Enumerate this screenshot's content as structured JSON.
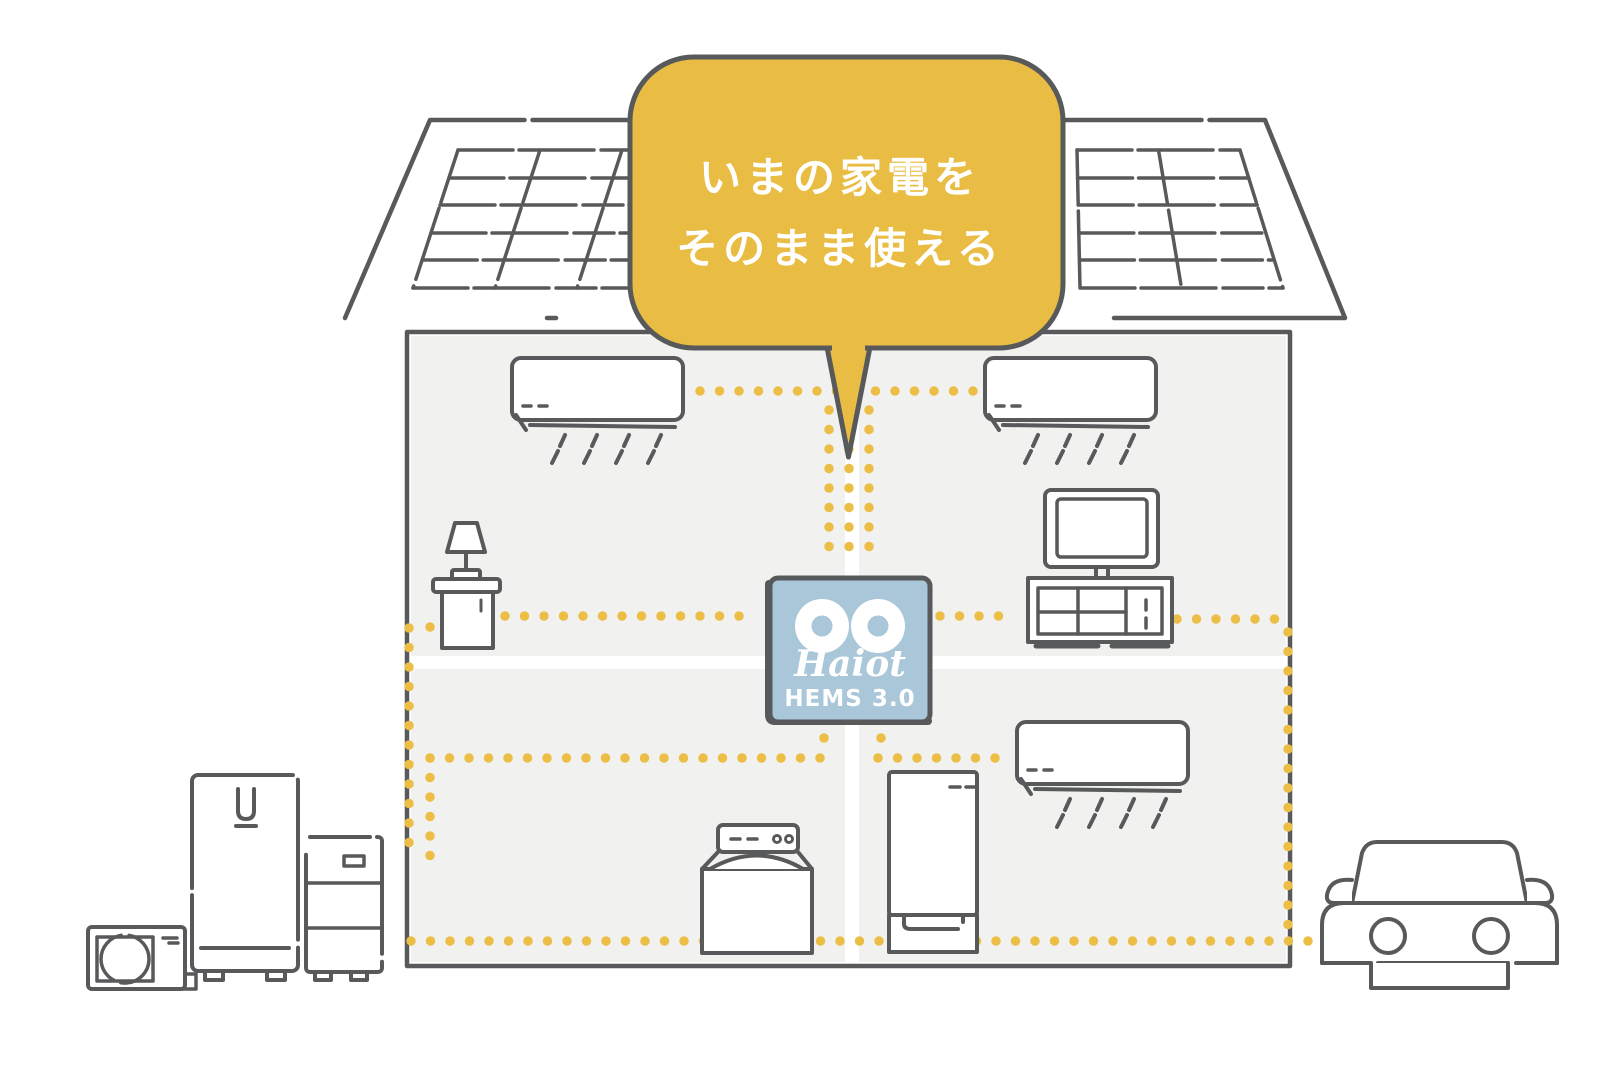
{
  "illustration": {
    "title_hidden": "",
    "speech_bubble": {
      "line1": "いまの家電を",
      "line2": "そのまま使える"
    },
    "hub": {
      "brand": "Haiot",
      "model": "HEMS 3.0"
    },
    "colors": {
      "accent_yellow": "#E9BC44",
      "dot_yellow": "#ECBE45",
      "outline_gray": "#58595B",
      "hub_blue": "#A9C7D8",
      "room_gray": "#F1F1F0",
      "text_white": "#FFFFFF"
    },
    "icons": [
      "solar-panel",
      "air-conditioner",
      "tv",
      "tv-stand",
      "lamp",
      "side-table",
      "hems-hub",
      "washing-machine",
      "refrigerator",
      "water-heater",
      "storage-battery",
      "heat-pump",
      "electric-car"
    ]
  }
}
